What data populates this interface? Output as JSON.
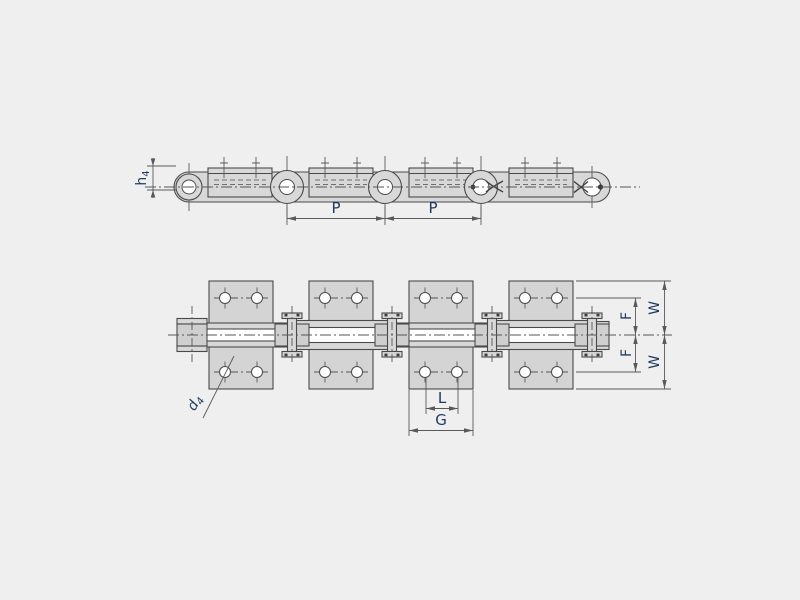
{
  "drawing": {
    "background": "#efefef",
    "outline_color": "#4a4a4a",
    "part_fill": "#d8d8d8",
    "plate_fill": "#d4d4d4",
    "dimension_line_color": "#58595b",
    "label_color": "#1e3a5f"
  },
  "dimensions": {
    "pitch1": {
      "label": "P"
    },
    "pitch2": {
      "label": "P"
    },
    "attachment_height": {
      "base": "h",
      "sub": "4"
    },
    "hole_diameter": {
      "base": "d",
      "sub": "4"
    },
    "hole_spacing": {
      "label": "L"
    },
    "attachment_length": {
      "label": "G"
    },
    "hole_offset_top": {
      "label": "F"
    },
    "hole_offset_bottom": {
      "label": "F"
    },
    "attachment_half_width_top": {
      "label": "W"
    },
    "attachment_half_width_bottom": {
      "label": "W"
    }
  }
}
